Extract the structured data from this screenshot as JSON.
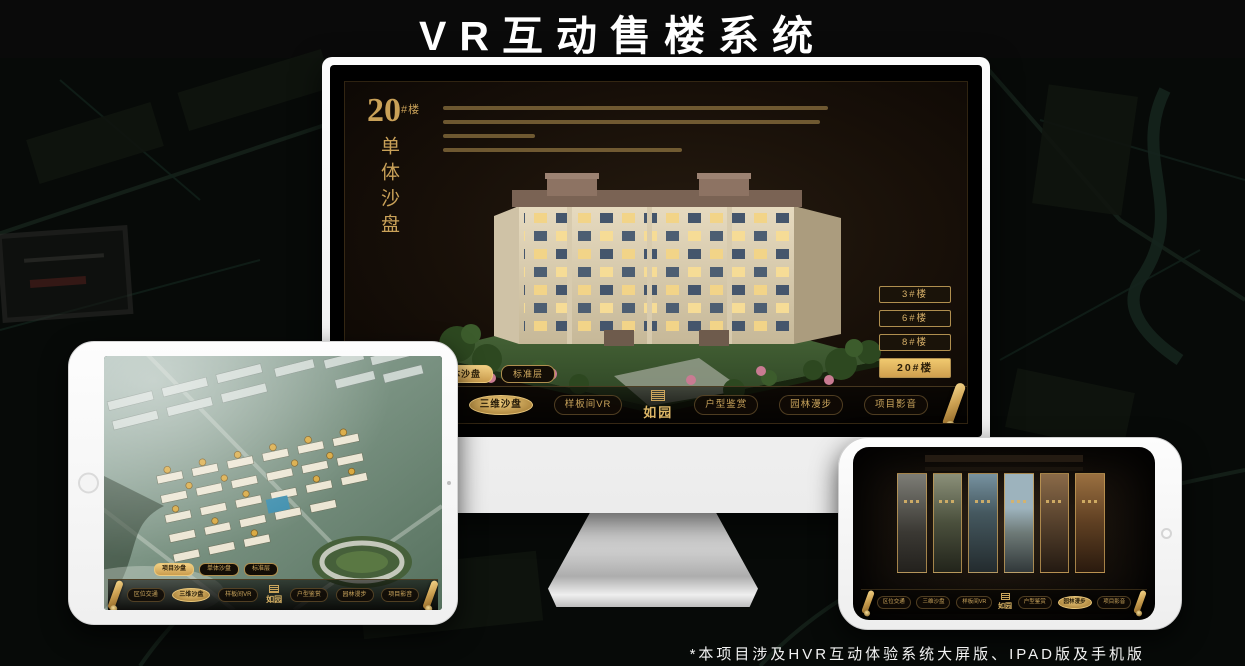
{
  "page": {
    "title": "VR互动售楼系统",
    "footnote": "*本项目涉及HVR互动体验系统大屏版、IPAD版及手机版"
  },
  "colors": {
    "gold": "#c9a158",
    "gold_bright": "#f0c96f",
    "screen_bg": "#170f08",
    "title_text": "#ffffff"
  },
  "logo": {
    "name": "如园"
  },
  "icons": {
    "nav_end": "scroll-icon",
    "logo_emblem": "seal-emblem-icon"
  },
  "monitor": {
    "heading_number": "20",
    "heading_suffix": "#楼",
    "heading_vertical": "单体沙盘",
    "floor_buttons": [
      {
        "label": "3#楼",
        "active": false
      },
      {
        "label": "6#楼",
        "active": false
      },
      {
        "label": "8#楼",
        "active": false
      },
      {
        "label": "20#楼",
        "active": true
      }
    ],
    "tabs": [
      {
        "label": "项目沙盘",
        "active": false
      },
      {
        "label": "单体沙盘",
        "active": true
      },
      {
        "label": "标准层",
        "active": false
      }
    ],
    "nav": [
      {
        "label": "区位交通",
        "active": false
      },
      {
        "label": "三维沙盘",
        "active": true
      },
      {
        "label": "样板间VR",
        "active": false
      },
      {
        "label": "户型鉴赏",
        "active": false
      },
      {
        "label": "园林漫步",
        "active": false
      },
      {
        "label": "项目影音",
        "active": false
      }
    ]
  },
  "ipad": {
    "tabs": [
      {
        "label": "项目沙盘",
        "active": true
      },
      {
        "label": "单体沙盘",
        "active": false
      },
      {
        "label": "标准层",
        "active": false
      }
    ],
    "nav": [
      {
        "label": "区位交通",
        "active": false
      },
      {
        "label": "三维沙盘",
        "active": true
      },
      {
        "label": "样板间VR",
        "active": false
      },
      {
        "label": "户型鉴赏",
        "active": false
      },
      {
        "label": "园林漫步",
        "active": false
      },
      {
        "label": "项目影音",
        "active": false
      }
    ]
  },
  "phone": {
    "nav": [
      {
        "label": "区位交通",
        "active": false
      },
      {
        "label": "三维沙盘",
        "active": false
      },
      {
        "label": "样板间VR",
        "active": false
      },
      {
        "label": "户型鉴赏",
        "active": false
      },
      {
        "label": "园林漫步",
        "active": true
      },
      {
        "label": "项目影音",
        "active": false
      }
    ]
  }
}
